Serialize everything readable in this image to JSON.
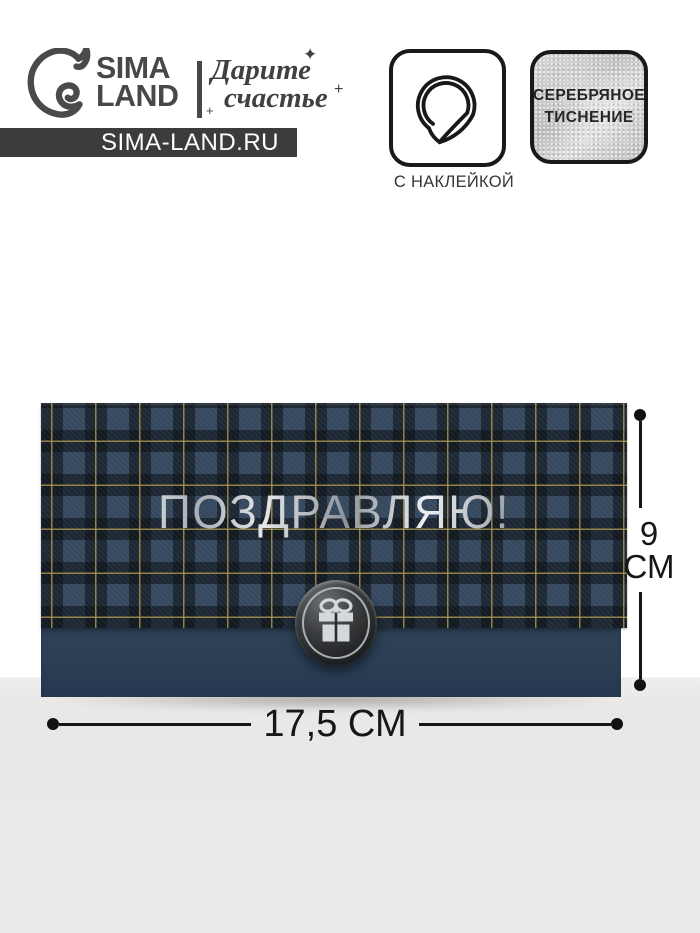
{
  "brand": {
    "name_line1": "SIMA",
    "name_line2": "LAND",
    "tagline_line1": "Дарите",
    "tagline_line2": "счастье",
    "website": "SIMA-LAND.RU"
  },
  "features": {
    "sticker_label": "С НАКЛЕЙКОЙ",
    "foil_line1": "СЕРЕБРЯНОЕ",
    "foil_line2": "ТИСНЕНИЕ"
  },
  "envelope": {
    "title": "ПОЗДРАВЛЯЮ!"
  },
  "dimensions": {
    "width_label": "17,5 СМ",
    "height_value": "9",
    "height_unit": "СМ"
  },
  "sparkles": {
    "star": "✦",
    "plus1": "+",
    "plus2": "+"
  },
  "icons": {
    "dolphin": "dolphin-logo-icon",
    "sticker": "peeling-sticker-icon",
    "gift": "gift-box-icon"
  },
  "colors": {
    "plaid_base": "#36495f",
    "plaid_dark": "#161b22",
    "plaid_accent": "#a3924f",
    "envelope_bottom": "#2b3f55",
    "silver_foil": "#d9dcdf",
    "floor": "#eae9e7",
    "ink": "#1a1a1a"
  }
}
